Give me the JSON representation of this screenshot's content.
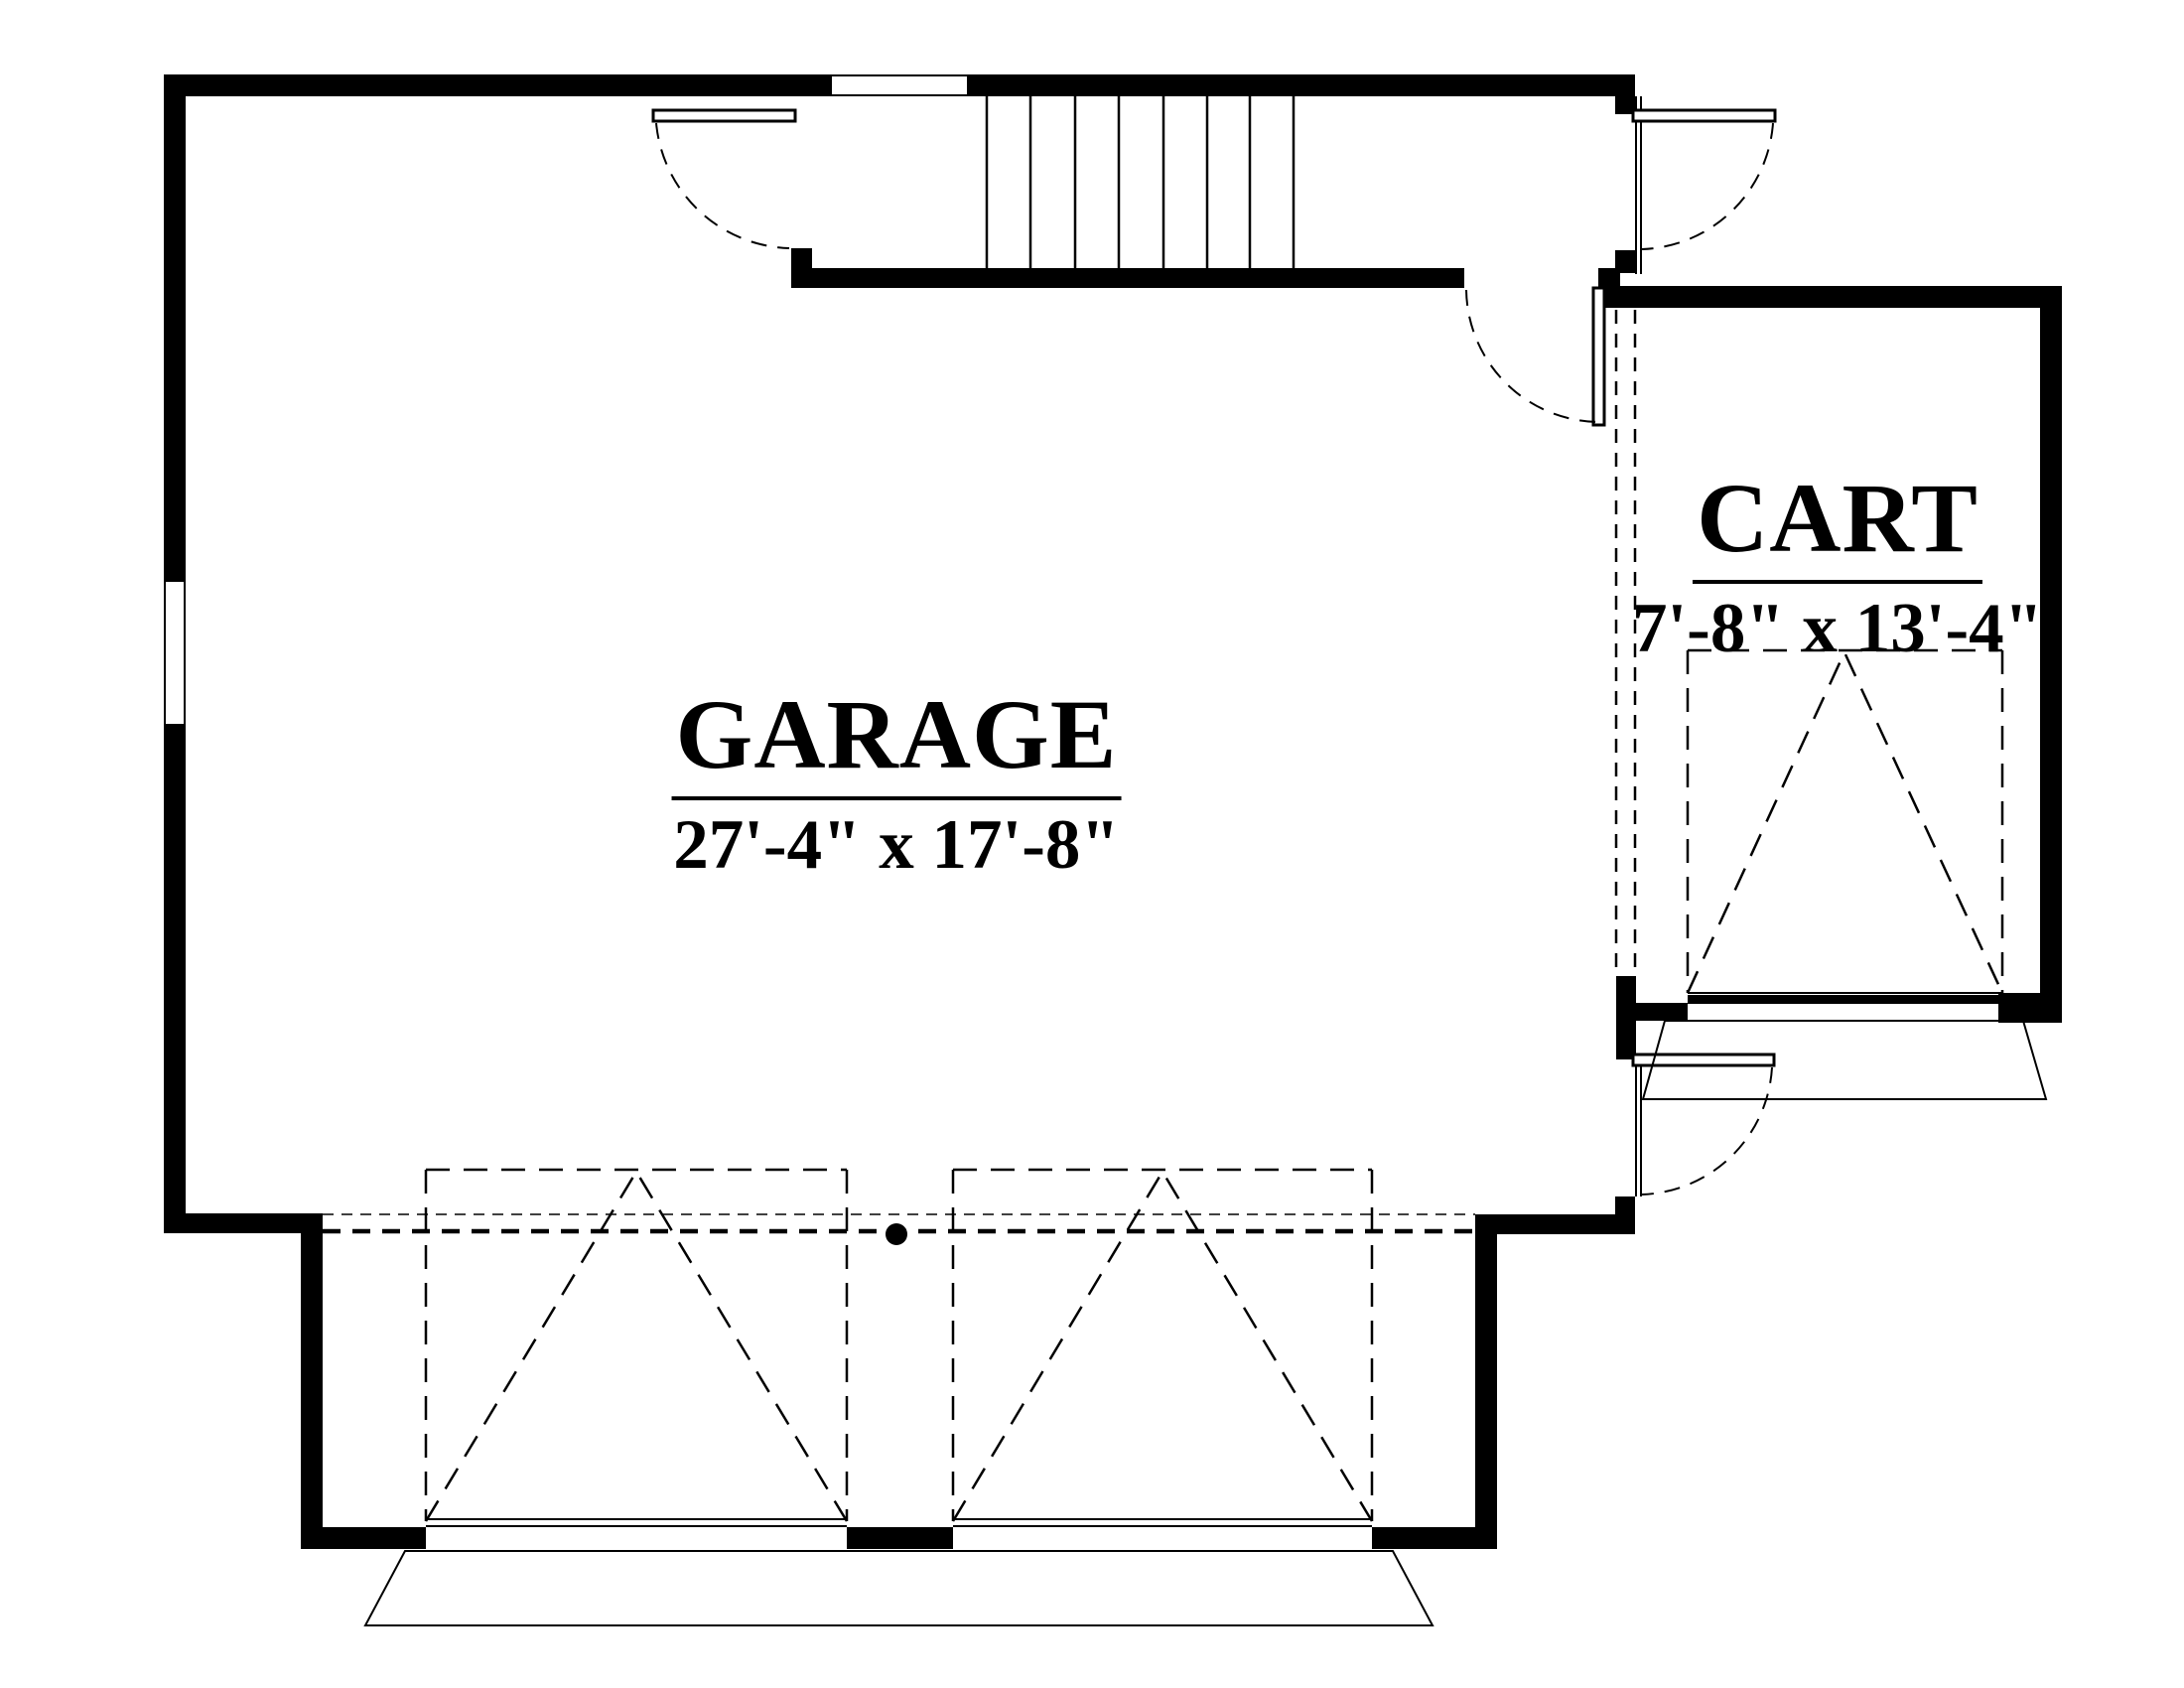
{
  "plan": {
    "type": "floor-plan",
    "rooms": [
      {
        "name": "GARAGE",
        "dimensions": "27'-4\" x 17'-8\""
      },
      {
        "name": "CART",
        "dimensions": "7'-8\" x 13'-4\""
      }
    ],
    "features": {
      "stair_treads": 8,
      "swing_doors": 4,
      "overhead_doors": 3,
      "windows": 2
    },
    "colors": {
      "ink": "#000000",
      "background": "#ffffff"
    }
  }
}
